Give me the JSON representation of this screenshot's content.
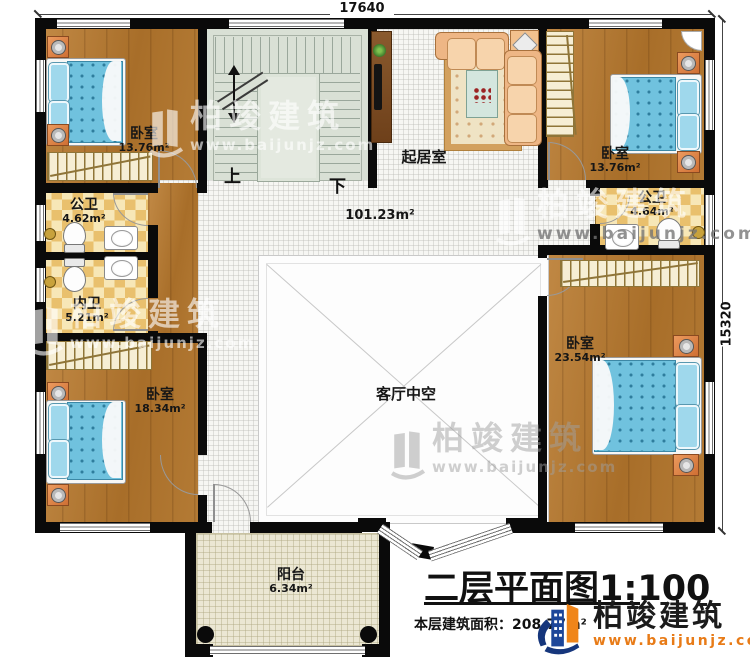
{
  "dimensions": {
    "top": "17640",
    "right": "15320"
  },
  "rooms": {
    "bedroom_tl": {
      "name": "卧室",
      "area": "13.76m²"
    },
    "bedroom_tr": {
      "name": "卧室",
      "area": "13.76m²"
    },
    "bath_public_left": {
      "name": "公卫",
      "area": "4.62m²"
    },
    "bath_inner": {
      "name": "内卫",
      "area": "5.21m²"
    },
    "bath_public_right": {
      "name": "公卫",
      "area": "4.64m²"
    },
    "bedroom_bl": {
      "name": "卧室",
      "area": "18.34m²"
    },
    "bedroom_right": {
      "name": "卧室",
      "area": "23.54m²"
    },
    "sitting_room": {
      "name": "起居室"
    },
    "hall": {
      "area": "101.23m²"
    },
    "void": {
      "name": "客厅中空"
    },
    "balcony": {
      "name": "阳台",
      "area": "6.34m²"
    }
  },
  "stairs": {
    "up_label": "上",
    "down_label": "下"
  },
  "titleblock": {
    "title": "二层平面图1:100",
    "floor_area_label": "本层建筑面积：208.77m²"
  },
  "brand": {
    "name": "柏竣建筑",
    "url": "www.baijunjz.com"
  },
  "watermark": {
    "name": "柏竣建筑",
    "url": "www.baijunjz.com"
  },
  "icons": {
    "brand_logo": "building-swoosh-logo",
    "watermark_logo": "building-swoosh-logo"
  },
  "colors": {
    "wall": "#0a0a0a",
    "wood": "#b57c36",
    "bath_checker": "#e9c06d",
    "stair_floor": "#d9e0d5",
    "corridor_tile": "#f6f6f3",
    "balcony_floor": "#ebe7d3",
    "bed_blue": "#70c2de",
    "brand_blue": "#1d4699",
    "brand_orange": "#f08519"
  }
}
